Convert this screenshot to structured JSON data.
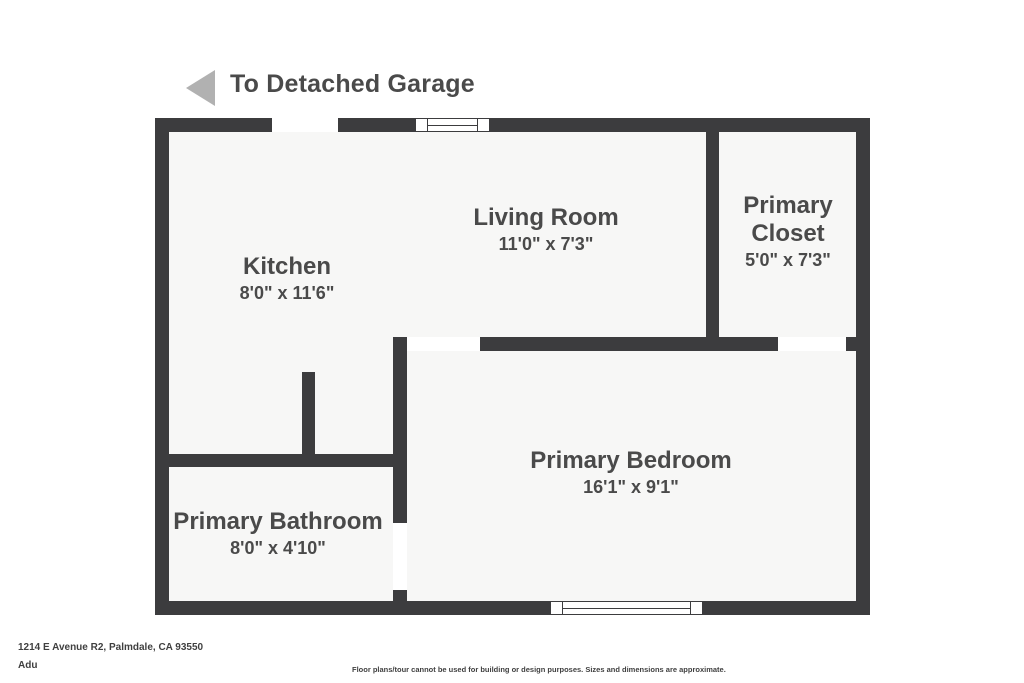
{
  "header": {
    "garage_label": "To Detached Garage",
    "arrow_direction": "left"
  },
  "rooms": [
    {
      "id": "kitchen",
      "name": "Kitchen",
      "dimensions": "8'0\" x 11'6\""
    },
    {
      "id": "living",
      "name": "Living Room",
      "dimensions": "11'0\" x 7'3\""
    },
    {
      "id": "closet",
      "name": "Primary Closet",
      "dimensions": "5'0\" x 7'3\""
    },
    {
      "id": "bedroom",
      "name": "Primary Bedroom",
      "dimensions": "16'1\" x 9'1\""
    },
    {
      "id": "bathroom",
      "name": "Primary Bathroom",
      "dimensions": "8'0\" x 4'10\""
    }
  ],
  "footer": {
    "address": "1214 E Avenue R2, Palmdale, CA 93550",
    "unit": "Adu",
    "disclaimer": "Floor plans/tour cannot be used for building or design purposes. Sizes and dimensions are approximate."
  },
  "colors": {
    "wall": "#3c3c3e",
    "room_fill": "#f7f7f6",
    "text": "#4a4a4a",
    "arrow": "#b1b1b1",
    "bg": "#ffffff"
  }
}
